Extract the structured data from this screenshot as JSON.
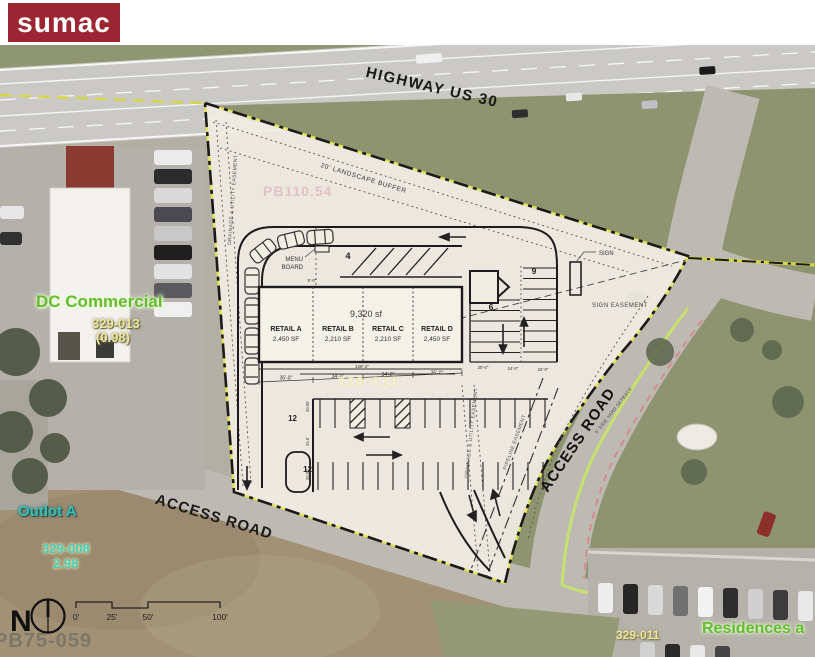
{
  "logo": {
    "text": "sumac"
  },
  "aerial": {
    "highway_label": "HIGHWAY US 30",
    "access_road_label_right": "ACCESS ROAD",
    "access_road_label_bottom": "ACCESS ROAD",
    "parcels": {
      "dc_commercial": {
        "name": "DC Commercial",
        "id": "329-013",
        "acreage": "(0.98)"
      },
      "outlot_a": {
        "name": "Outlot A",
        "id": "329-008",
        "acreage": "2.98"
      },
      "residences": {
        "name": "Residences a",
        "id": "329-011"
      }
    },
    "plat_refs": {
      "bottom_left": "PB75-059",
      "upper": "PB110.54",
      "site": "329-010"
    }
  },
  "site_plan": {
    "building": {
      "total_area": "9,320 sf",
      "units": [
        {
          "name": "RETAIL A",
          "area": "2,450 SF"
        },
        {
          "name": "RETAIL B",
          "area": "2,210 SF"
        },
        {
          "name": "RETAIL C",
          "area": "2,210 SF"
        },
        {
          "name": "RETAIL D",
          "area": "2,450 SF"
        }
      ]
    },
    "annotations": {
      "menu_line1": "MENU",
      "menu_line2": "BOARD",
      "sign": "SIGN",
      "sign_easement": "SIGN EASEMENT",
      "landscape_buffer": "20' LANDSCAPE BUFFER",
      "drainage_left": "DRAINAGE & UTILITY EASEMENT",
      "drainage_right": "DRAINAGE & UTILITY EASEMENT",
      "pipeline": "PIPELINE EASEMENT",
      "side_yard": "5' SIDE YARD SETBACK"
    },
    "stall_counts": {
      "drive_thru": "4",
      "east_right": "9",
      "east_left": "6",
      "row_a": "12",
      "row_b": "12"
    },
    "dims": {
      "total": "138'-2\"",
      "bay1": "35'-0\"",
      "bay2": "34'-0\"",
      "bay3": "34'-0\"",
      "bay4": "35'-0\"",
      "menu": "5'-0\"",
      "east1": "20'-0\"",
      "east2": "24'-0\"",
      "east3": "20'-0\"",
      "w1": "20.00'",
      "w2": "24.0'",
      "w3": "20.00'"
    }
  },
  "compass": {
    "north": "N"
  },
  "scale_bar": {
    "ticks": [
      "0'",
      "25'",
      "50'",
      "100'"
    ]
  }
}
